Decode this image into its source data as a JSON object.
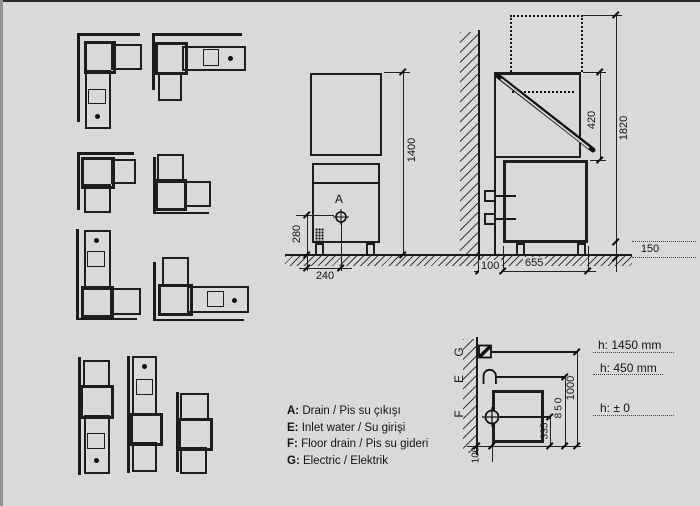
{
  "colors": {
    "background": "#d9d9d9",
    "line": "#1a1a1a",
    "accent": "#0d0d0d"
  },
  "front_elevation": {
    "drain_point_label": "A",
    "dims": {
      "total_height": "1400",
      "drain_height": "280",
      "drain_offset": "240"
    }
  },
  "side_elevation": {
    "dims": {
      "hood_opening": "420",
      "total_height_open": "1820",
      "base_height": "150",
      "depth": "655",
      "wall_clearance": "100"
    }
  },
  "plan_detail": {
    "connection_labels": {
      "electric": "G",
      "inlet_water": "E",
      "floor_drain": "F"
    },
    "dims": {
      "total_depth": "1000",
      "inlet_distance": "850",
      "drain_distance": "335",
      "wall_clearance": "100"
    },
    "height_notes": [
      "h: 1450 mm",
      "h: 450 mm",
      "h: ± 0"
    ]
  },
  "legend": {
    "items": [
      {
        "key": "A:",
        "text": "Drain / Pis su çıkışı"
      },
      {
        "key": "E:",
        "text": "Inlet water / Su girişi"
      },
      {
        "key": "F:",
        "text": "Floor drain / Pis su gideri"
      },
      {
        "key": "G:",
        "text": "Electric / Elektrik"
      }
    ]
  },
  "symbols": {
    "drain": "circle-cross",
    "floor_drain": "circle-cross",
    "inlet_water": "dome",
    "electric": "square-diagonal"
  }
}
